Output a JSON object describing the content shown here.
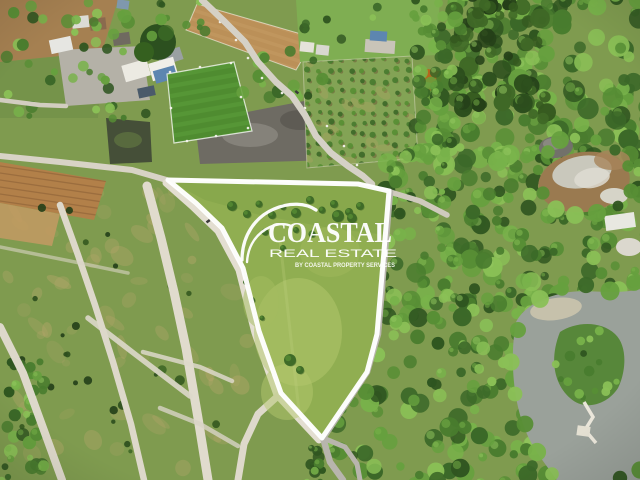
{
  "image": {
    "kind": "aerial-drone-photo",
    "subject": "land parcel for sale outlined in white",
    "width_px": 640,
    "height_px": 480
  },
  "watermark": {
    "brand": "COASTAL",
    "subtitle": "REAL ESTATE",
    "tagline": "BY COASTAL PROPERTY SERVICES",
    "color": "#ffffff"
  },
  "boundary": {
    "points": "168,180 358,184 389,191 383,263 377,334 367,372 322,438 281,393 259,331 243,268 222,228 196,203",
    "color": "#ffffff",
    "stroke_width": 5
  },
  "colors": {
    "scrub": "#7f9b4f",
    "meadow": "#90ae51",
    "meadow_light": "#b3c76e",
    "forest_dark": "#2c4e1d",
    "forest_mid": "#578e35",
    "forest_light": "#8ac056",
    "dirt_road": "#e0dbcd",
    "asphalt": "#b8b5ad",
    "soil": "#b28049",
    "turf_tan": "#bb9058",
    "turf_green": "#4f8c30",
    "gravel": "#b4b1a7",
    "gravel_dark": "#6e6b63",
    "pond_dark": "#454f38",
    "water": "#9aa19a",
    "outline": "#ffffff"
  }
}
